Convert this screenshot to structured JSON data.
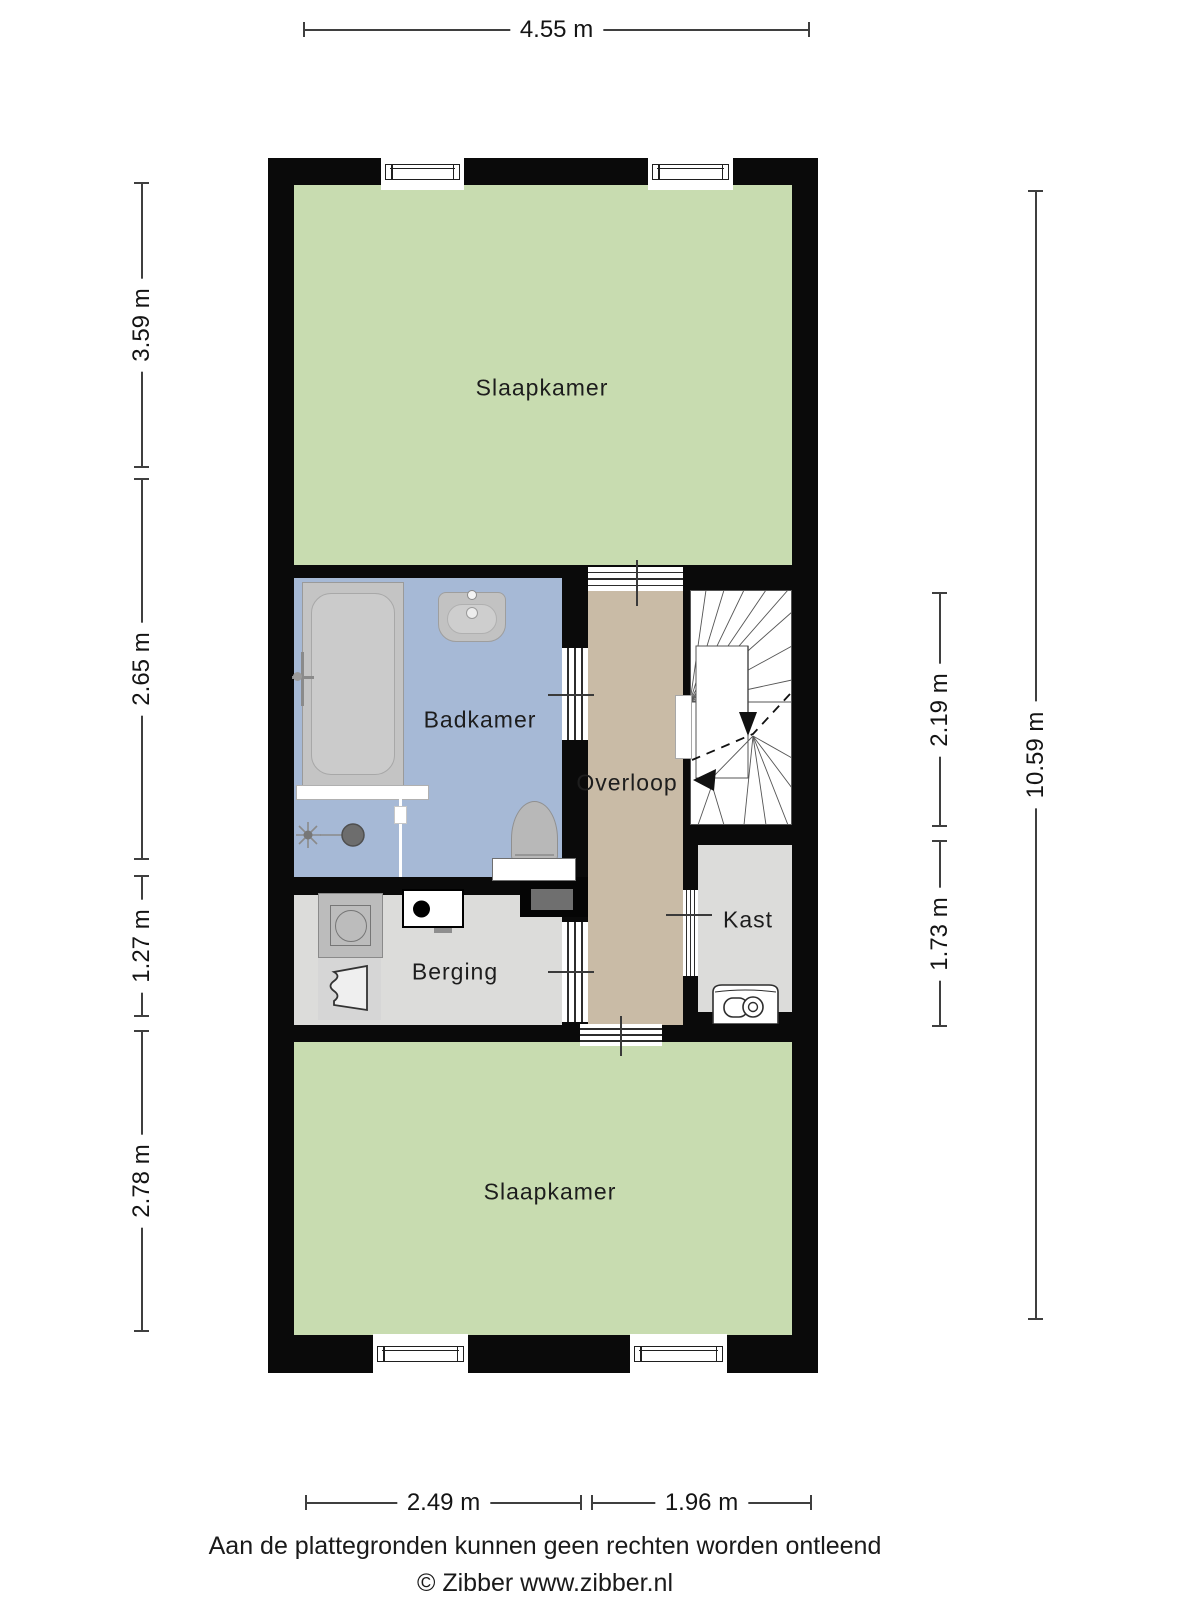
{
  "plan": {
    "rooms": {
      "bedroom_top": "Slaapkamer",
      "bathroom": "Badkamer",
      "landing": "Overloop",
      "closet": "Kast",
      "storage": "Berging",
      "bedroom_bottom": "Slaapkamer"
    },
    "dimensions": {
      "total_width": "4.55 m",
      "total_height": "10.59 m",
      "left_top": "3.59 m",
      "left_middle": "2.65 m",
      "left_lower": "1.27 m",
      "left_bottom": "2.78 m",
      "right_stairs": "2.19 m",
      "right_closet": "1.73 m",
      "bottom_left": "2.49 m",
      "bottom_right": "1.96 m"
    },
    "colors": {
      "wall": "#0a0a0a",
      "bedroom": "#c8dcb0",
      "bathroom": "#a6b9d6",
      "landing": "#c9bba6",
      "closet": "#dcdcda",
      "storage": "#dcdcda",
      "stairs": "#ffffff"
    }
  },
  "footer": {
    "disclaimer": "Aan de plattegronden kunnen geen rechten worden ontleend",
    "copyright": "© Zibber www.zibber.nl"
  }
}
